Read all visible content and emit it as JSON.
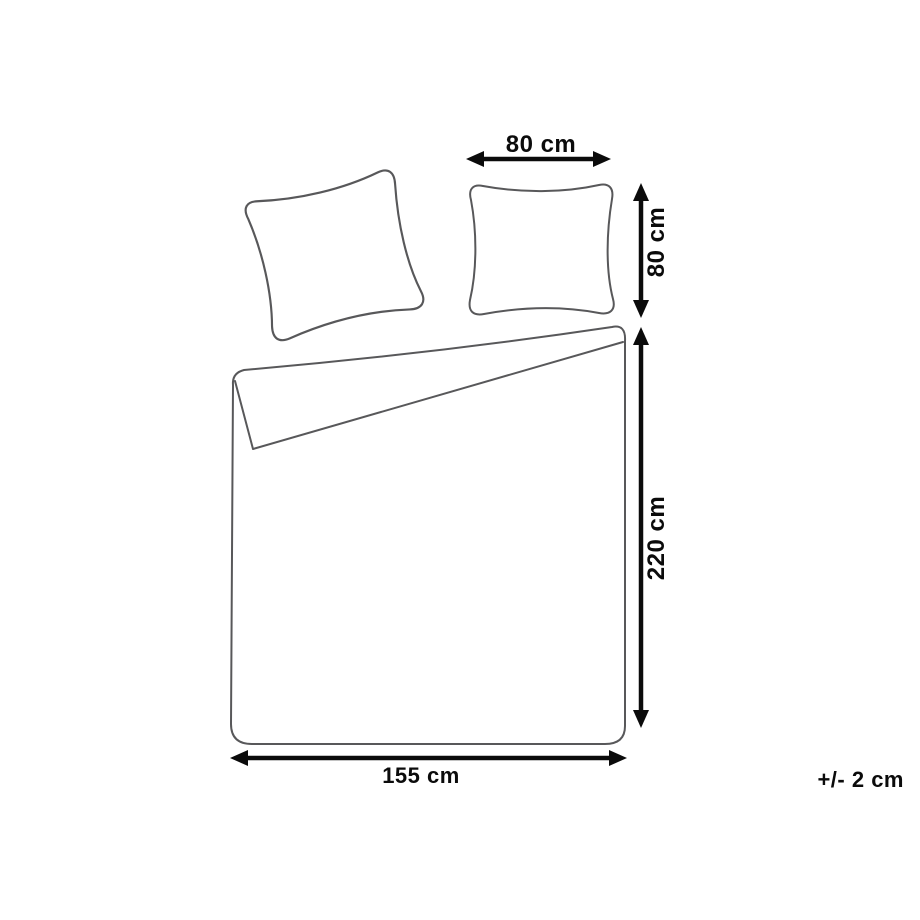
{
  "diagram": {
    "kind": "bedding-size-diagram",
    "shapes": {
      "left_pillow": "pillowcase outline, tilted",
      "right_pillow": "pillowcase outline, straight",
      "duvet": "duvet cover outline with folded-back top corner"
    },
    "colors": {
      "background": "#ffffff",
      "outline": "#58585a",
      "dimension_lines": "#0b0b0b",
      "text": "#0b0b0b"
    }
  },
  "dimensions": {
    "pillow_width": {
      "label": "80 cm",
      "orientation": "horizontal"
    },
    "pillow_height": {
      "label": "80 cm",
      "orientation": "vertical"
    },
    "duvet_length": {
      "label": "220 cm",
      "orientation": "vertical"
    },
    "duvet_width": {
      "label": "155 cm",
      "orientation": "horizontal"
    },
    "tolerance": {
      "label": "+/- 2 cm",
      "orientation": "horizontal"
    }
  }
}
